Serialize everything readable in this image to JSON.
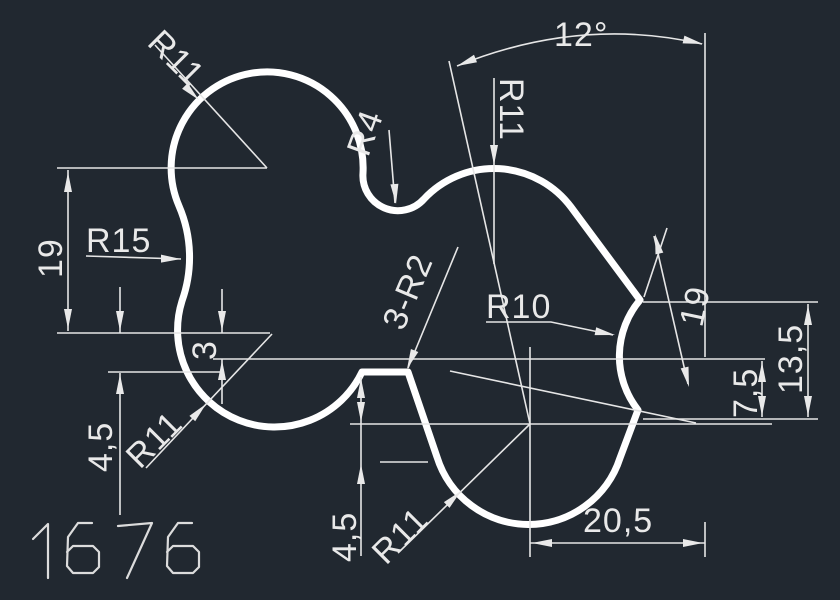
{
  "canvas": {
    "background_color": "#212830",
    "profile_color": "#ffffff",
    "dimension_color": "#e6e6e6"
  },
  "drawing_number": "1676",
  "dimensions": {
    "angle_top": "12°",
    "height_left": "19",
    "height_right_slanted": "19",
    "offset_small": "3",
    "offset_left": "4,5",
    "offset_bottom": "4,5",
    "offset_right_lower": "7,5",
    "offset_right_upper": "13,5",
    "width_bottom": "20,5"
  },
  "radii": {
    "top_left_lobe": "R11",
    "top_right_lobe": "R11",
    "bottom_left_lobe": "R11",
    "bottom_right_lobe": "R11",
    "left_waist_fillet": "R15",
    "top_notch_fillet": "R4",
    "right_notch_fillet": "R10",
    "corner_fillets_note": "3-R2"
  }
}
